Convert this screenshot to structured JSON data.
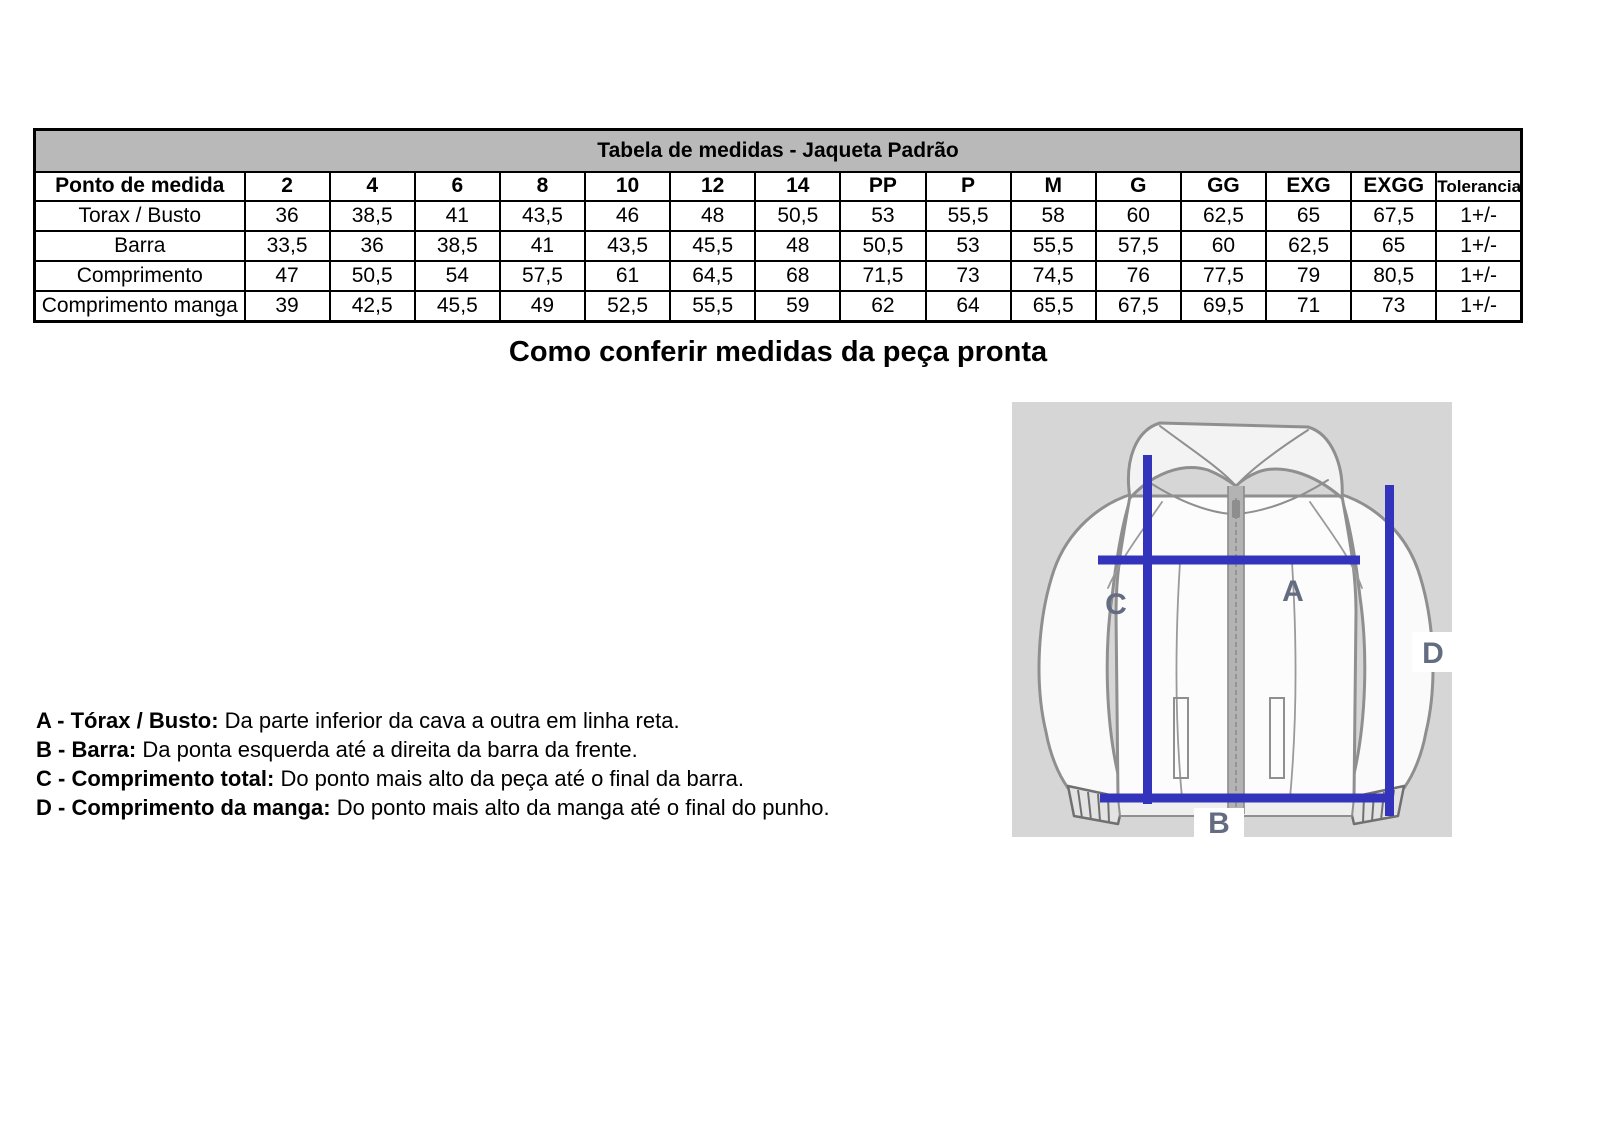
{
  "colors": {
    "measure-blue": "#3333bb",
    "measure-label": "#646c82",
    "table-title-bg": "#b9b9b9",
    "diagram-bg": "#d6d6d6"
  },
  "table": {
    "title": "Tabela de medidas - Jaqueta Padrão",
    "columns": [
      "Ponto de medida",
      "2",
      "4",
      "6",
      "8",
      "10",
      "12",
      "14",
      "PP",
      "P",
      "M",
      "G",
      "GG",
      "EXG",
      "EXGG",
      "Tolerancia"
    ],
    "rows": [
      {
        "label": "Torax / Busto",
        "values": [
          "36",
          "38,5",
          "41",
          "43,5",
          "46",
          "48",
          "50,5",
          "53",
          "55,5",
          "58",
          "60",
          "62,5",
          "65",
          "67,5",
          "1+/-"
        ]
      },
      {
        "label": "Barra",
        "values": [
          "33,5",
          "36",
          "38,5",
          "41",
          "43,5",
          "45,5",
          "48",
          "50,5",
          "53",
          "55,5",
          "57,5",
          "60",
          "62,5",
          "65",
          "1+/-"
        ]
      },
      {
        "label": "Comprimento",
        "values": [
          "47",
          "50,5",
          "54",
          "57,5",
          "61",
          "64,5",
          "68",
          "71,5",
          "73",
          "74,5",
          "76",
          "77,5",
          "79",
          "80,5",
          "1+/-"
        ]
      },
      {
        "label": "Comprimento manga",
        "values": [
          "39",
          "42,5",
          "45,5",
          "49",
          "52,5",
          "55,5",
          "59",
          "62",
          "64",
          "65,5",
          "67,5",
          "69,5",
          "71",
          "73",
          "1+/-"
        ]
      }
    ]
  },
  "heading": "Como conferir medidas da peça pronta",
  "annotations": [
    {
      "label": "A - Tórax / Busto:",
      "text": " Da parte inferior da cava a outra em linha reta."
    },
    {
      "label": "B - Barra:",
      "text": " Da ponta esquerda até a direita da barra da frente."
    },
    {
      "label": "C - Comprimento total:",
      "text": " Do ponto mais alto da peça até o final da barra."
    },
    {
      "label": "D - Comprimento da manga:",
      "text": " Do ponto mais alto da manga até o final do punho."
    }
  ],
  "diagram": {
    "labels": {
      "a": "A",
      "b": "B",
      "c": "C",
      "d": "D"
    }
  }
}
